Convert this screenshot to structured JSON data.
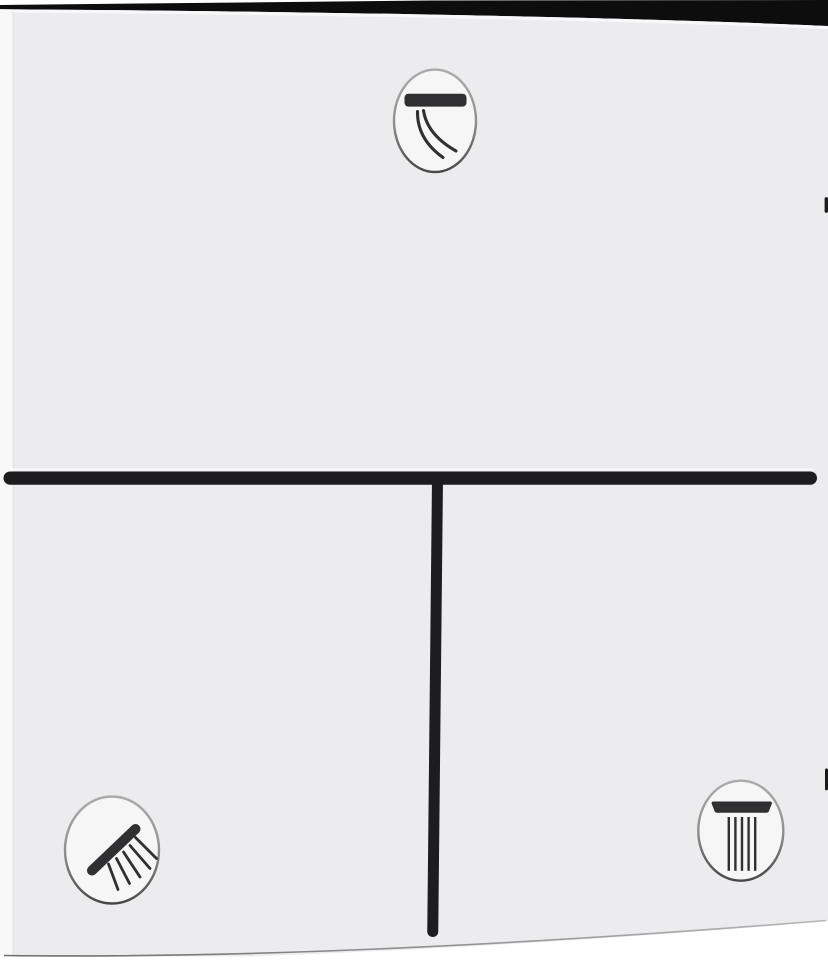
{
  "scene": {
    "alt": "White square shower thermostat trim plate, photographed at a slight angle, with a black T-shaped divider groove and three round function-select buttons"
  },
  "colors": {
    "background": "#ffffff",
    "panel_face": "#ececee",
    "panel_side": "#f7f8f8",
    "panel_top_highlight": "#f9fafa",
    "top_edge": "#0d0d0d",
    "divider": "#1d1d1f",
    "divider_highlight": "#ffffff",
    "icon": "#303032",
    "button_face": "#f6f6f7",
    "ring_top": "#ababab",
    "ring_mid": "#909090",
    "ring_bottom": "#474747",
    "notch": "#1a1a1a",
    "bottom_edge_dark": "#4a4a4a",
    "bottom_edge_light": "#a8a8a8"
  },
  "buttons": [
    {
      "position": "top-center",
      "icon": "bath-spout-icon",
      "function": "bath-spout-outlet"
    },
    {
      "position": "bottom-left",
      "icon": "hand-shower-icon",
      "function": "hand-shower-outlet"
    },
    {
      "position": "bottom-right",
      "icon": "overhead-shower-icon",
      "function": "overhead-shower-outlet"
    }
  ]
}
